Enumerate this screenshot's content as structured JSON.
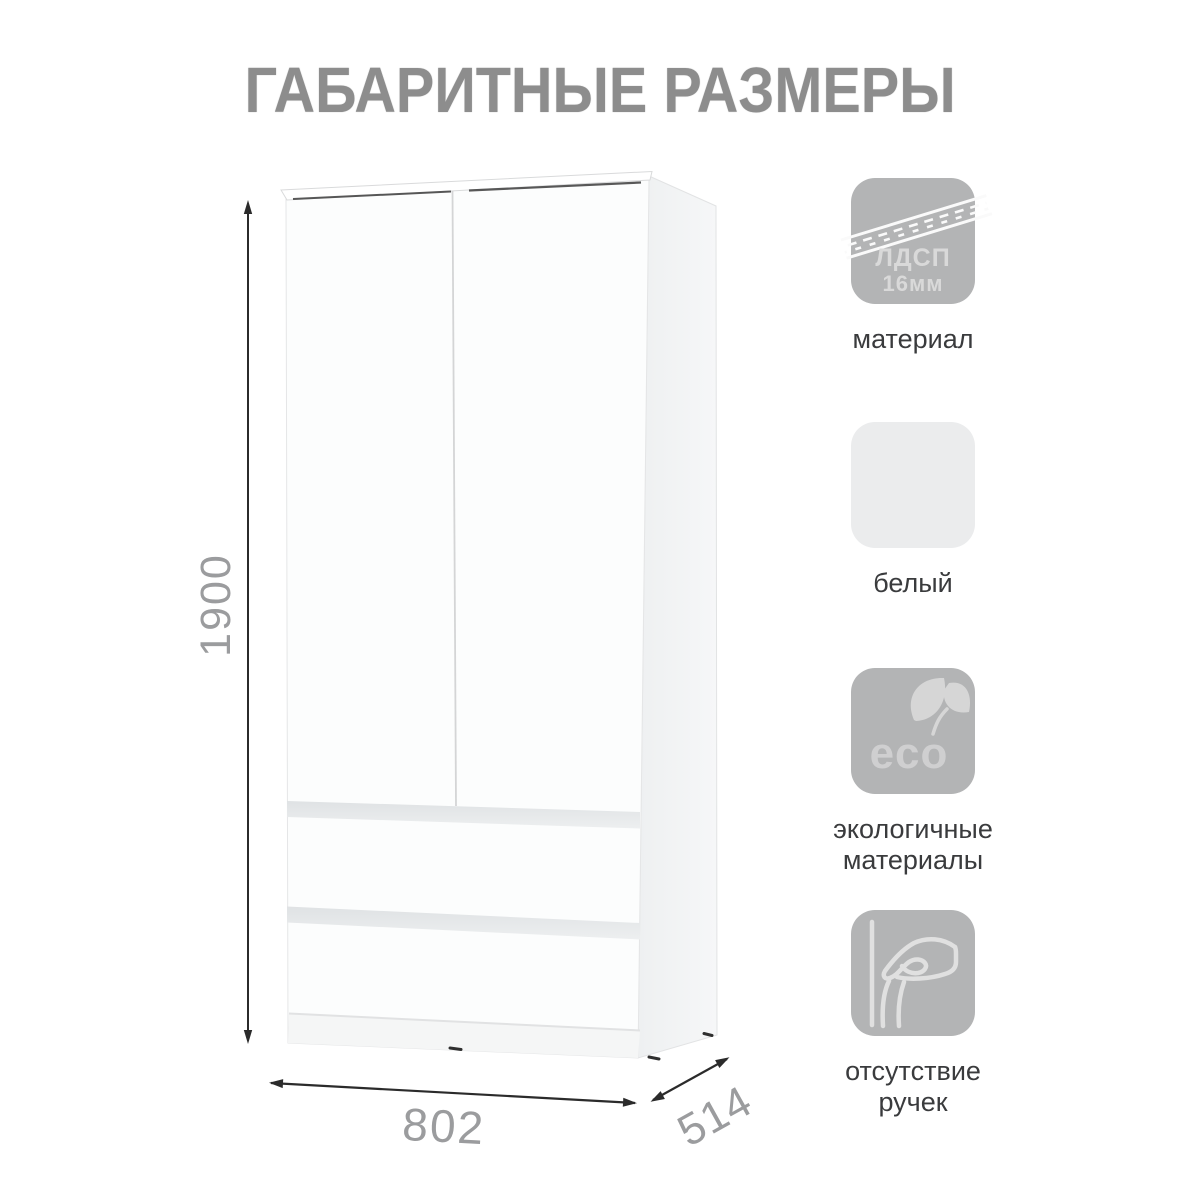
{
  "title": "ГАБАРИТНЫЕ РАЗМЕРЫ",
  "diagram": {
    "object": "two-door wardrobe with two drawers, white, no handles",
    "height_mm": "1900",
    "width_mm": "802",
    "depth_mm": "514"
  },
  "features": [
    {
      "name": "material",
      "icon": "chipboard-edge-icon",
      "icon_line1": "ЛДСП",
      "icon_line2": "16мм",
      "label_lines": [
        "материал"
      ]
    },
    {
      "name": "color",
      "icon": "white-color-swatch",
      "label_lines": [
        "белый"
      ]
    },
    {
      "name": "eco",
      "icon": "eco-leaves-icon",
      "icon_text": "eco",
      "label_lines": [
        "экологичные",
        "материалы"
      ]
    },
    {
      "name": "no-handles",
      "icon": "hand-grip-icon",
      "label_lines": [
        "отсутствие",
        "ручек"
      ]
    }
  ],
  "colors": {
    "title_gray": "#8d8d8d",
    "icon_gray": "#b3b4b5",
    "swatch_white": "#ebeced",
    "dimension_line": "#2b2b2b",
    "dimension_text": "#9b9c9e",
    "drawer_groove": "#e4e6e8",
    "label_text": "#3a3b3d"
  }
}
